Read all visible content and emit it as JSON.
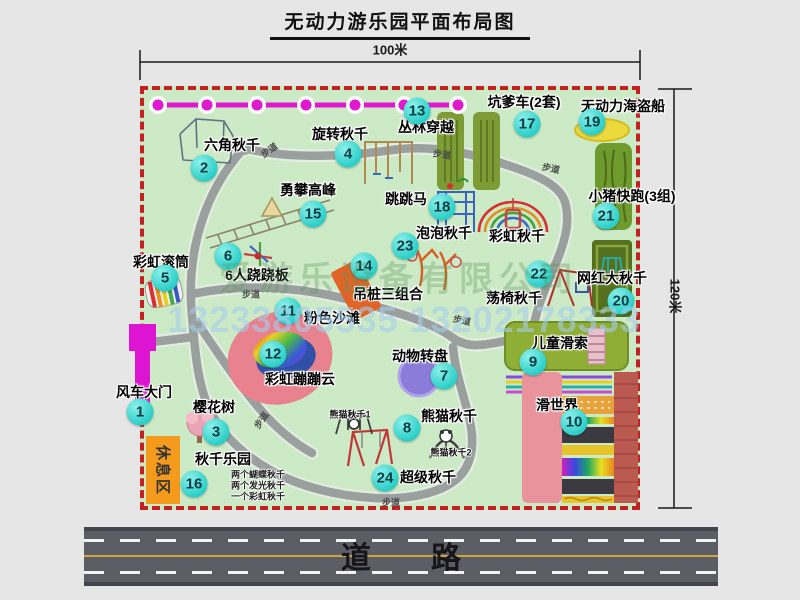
{
  "title": "无动力游乐园平面布局图",
  "dimension_top": "100米",
  "dimension_right": "120米",
  "road_label": "道　　路",
  "trail_text": "步道",
  "rest_area_label": "休息区",
  "watermark_company": "爱游乐设备有限公司",
  "watermark_phone": "13233805535 13202178333",
  "colors": {
    "map_bg": "#cdeac6",
    "border_red": "#c32020",
    "badge_cyan": "#2bcfc8",
    "magenta": "#dd14d2",
    "path_gray": "#9aa09d",
    "rest_orange": "#f49b1e",
    "road_gray": "#5d5d66",
    "pad_olive": "#7d9c35",
    "pirate_yellow": "#ecd93e",
    "turntable_purple": "#8a7cd8",
    "beach_pink": "#e8828e",
    "slab_orange": "#e06428"
  },
  "attractions": [
    {
      "num": "1",
      "name": "风车大门",
      "bx": -4,
      "by": 322,
      "lx": 0,
      "ly": 302
    },
    {
      "num": "2",
      "name": "六角秋千",
      "bx": 60,
      "by": 78,
      "lx": 88,
      "ly": 55
    },
    {
      "num": "3",
      "name": "樱花树",
      "bx": 72,
      "by": 342,
      "lx": 70,
      "ly": 317
    },
    {
      "num": "4",
      "name": "旋转秋千",
      "bx": 204,
      "by": 64,
      "lx": 196,
      "ly": 44
    },
    {
      "num": "5",
      "name": "彩虹滚筒",
      "bx": 21,
      "by": 188,
      "lx": 17,
      "ly": 172
    },
    {
      "num": "6",
      "name": "6人跷跷板",
      "bx": 84,
      "by": 166,
      "lx": 113,
      "ly": 185
    },
    {
      "num": "7",
      "name": "动物转盘",
      "bx": 300,
      "by": 286,
      "lx": 276,
      "ly": 266
    },
    {
      "num": "8",
      "name": "熊猫秋千",
      "bx": 263,
      "by": 338,
      "lx": 305,
      "ly": 326
    },
    {
      "num": "9",
      "name": "儿童滑索",
      "bx": 389,
      "by": 272,
      "lx": 416,
      "ly": 253
    },
    {
      "num": "10",
      "name": "滑世界",
      "bx": 430,
      "by": 332,
      "lx": 413,
      "ly": 315
    },
    {
      "num": "11",
      "name": "粉色沙滩",
      "bx": 144,
      "by": 221,
      "lx": 188,
      "ly": 228
    },
    {
      "num": "12",
      "name": "彩虹蹦蹦云",
      "bx": 129,
      "by": 264,
      "lx": 156,
      "ly": 289
    },
    {
      "num": "13",
      "name": "丛林穿越",
      "bx": 273,
      "by": 21,
      "lx": 282,
      "ly": 37
    },
    {
      "num": "14",
      "name": "吊桩三组合",
      "bx": 220,
      "by": 176,
      "lx": 244,
      "ly": 204
    },
    {
      "num": "15",
      "name": "勇攀高峰",
      "bx": 169,
      "by": 124,
      "lx": 164,
      "ly": 100
    },
    {
      "num": "16",
      "name": "秋千乐园",
      "bx": 50,
      "by": 394,
      "lx": 79,
      "ly": 369
    },
    {
      "num": "17",
      "name": "坑爹车(2套)",
      "bx": 383,
      "by": 34,
      "lx": 380,
      "ly": 12
    },
    {
      "num": "18",
      "name": "跳跳马",
      "bx": 298,
      "by": 117,
      "lx": 262,
      "ly": 109
    },
    {
      "num": "19",
      "name": "无动力海盗船",
      "bx": 448,
      "by": 32,
      "lx": 479,
      "ly": 16
    },
    {
      "num": "20",
      "name": "网红大秋千",
      "bx": 477,
      "by": 211,
      "lx": 468,
      "ly": 188
    },
    {
      "num": "21",
      "name": "小猪快跑(3组)",
      "bx": 462,
      "by": 126,
      "lx": 488,
      "ly": 106
    },
    {
      "num": "22",
      "name": "荡椅秋千",
      "bx": 395,
      "by": 184,
      "lx": 370,
      "ly": 208
    },
    {
      "num": "23",
      "name": "泡泡秋千",
      "bx": 261,
      "by": 156,
      "lx": 300,
      "ly": 143
    },
    {
      "num": "24",
      "name": "超级秋千",
      "bx": 241,
      "by": 388,
      "lx": 284,
      "ly": 387
    }
  ],
  "extra_labels": [
    {
      "text": "彩虹秋千",
      "x": 373,
      "y": 146,
      "cls": "lbl"
    },
    {
      "text": "熊猫秋千1",
      "x": 206,
      "y": 324,
      "cls": "sub"
    },
    {
      "text": "熊猫秋千2",
      "x": 307,
      "y": 362,
      "cls": "sub"
    }
  ],
  "swing_park_notes": [
    "两个蝴蝶秋千",
    "两个发光秋千",
    "一个彩虹秋千"
  ],
  "notes_origin": {
    "x": 87,
    "y": 384,
    "dy": 11
  },
  "trail_positions": [
    {
      "x": 125,
      "y": 60,
      "r": -35
    },
    {
      "x": 298,
      "y": 64,
      "r": 8
    },
    {
      "x": 407,
      "y": 78,
      "r": 12
    },
    {
      "x": 107,
      "y": 204,
      "r": 0
    },
    {
      "x": 318,
      "y": 230,
      "r": 12
    },
    {
      "x": 117,
      "y": 330,
      "r": -55
    },
    {
      "x": 247,
      "y": 412,
      "r": 0
    }
  ]
}
